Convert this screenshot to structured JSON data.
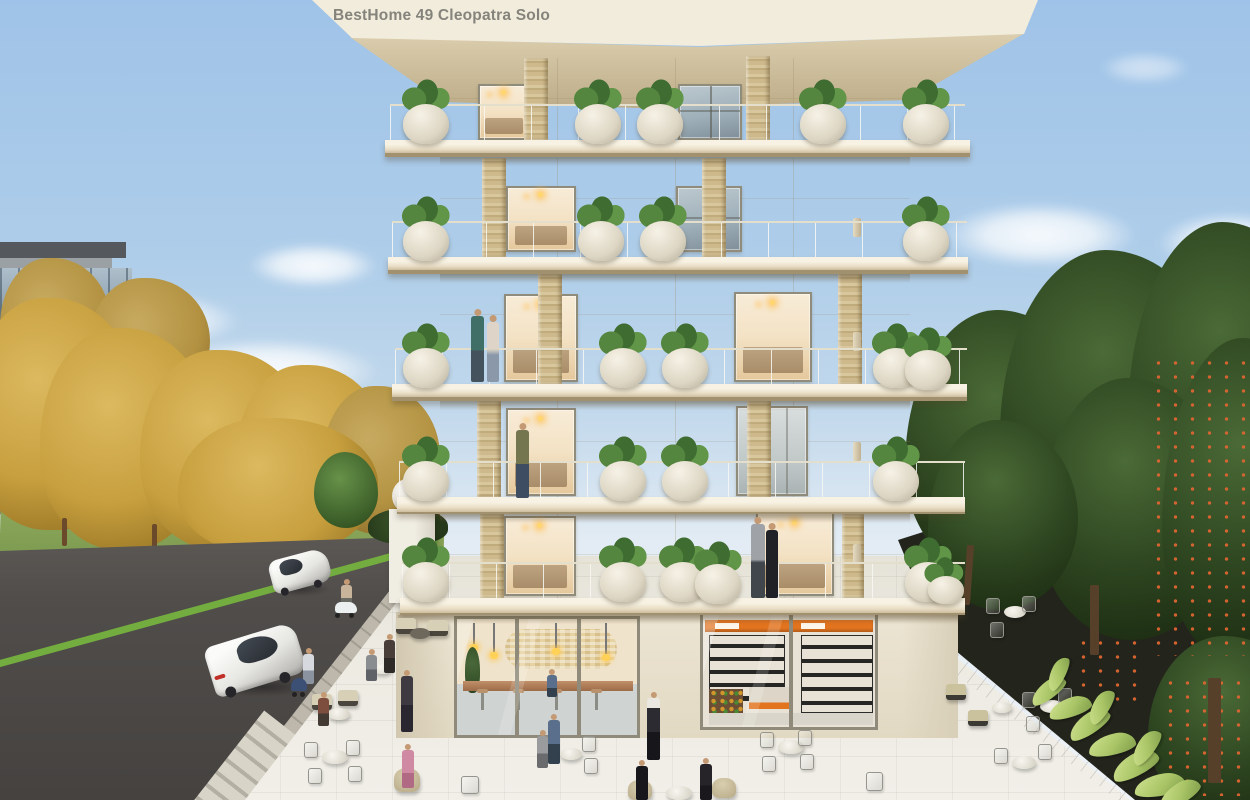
{
  "scene": {
    "type": "3d-architectural-exterior-render",
    "sign": {
      "text": "BestHome 49 Cleopatra Solo"
    },
    "building": {
      "storeys_visible": 6,
      "residential_floors": 5,
      "ground_floor_shops": [
        "cafe",
        "mini-market"
      ],
      "features": [
        "wide balcony slabs",
        "glass balustrades",
        "round stone planters with green plants",
        "gold travertine columns"
      ]
    },
    "street_scene": {
      "vehicles": [
        "white sedan near",
        "white sedan far",
        "scooter rider"
      ],
      "left_background": "autumn park with golden trees and modern glass building",
      "right_background": "dense green trees with orange fruit",
      "foreground": "outdoor cafe seating on white plaza"
    },
    "palette": {
      "sky_top": "#9fc3e8",
      "sky_horizon": "#e3ecf4",
      "facade": "#eae3d0",
      "fascia": "#f2ecdc",
      "slab_dark": "#a2916f",
      "column_gold": "#cdb98c",
      "window_warm": "#f3e2c4",
      "glass_cool": "#9fb0ba",
      "road": "#4e4b49",
      "bike_lane": "#74ad3f",
      "plaza": "#eceae1",
      "paver": "#bdb8ab",
      "lawn": "#7e9c51",
      "track": "#9b6f4e",
      "autumn": "#c79f3e",
      "autumn_deep": "#9a7726",
      "tree_dark": "#2c431f",
      "tree_deep": "#1c2c12",
      "fruit": "#dd6530",
      "plant": "#4d7c3a",
      "plant_light": "#a9c566",
      "market_accent": "#e2731f",
      "stone_wall": "#9b958a",
      "sign_color": "#85847c",
      "skin": "#c49a74"
    }
  }
}
